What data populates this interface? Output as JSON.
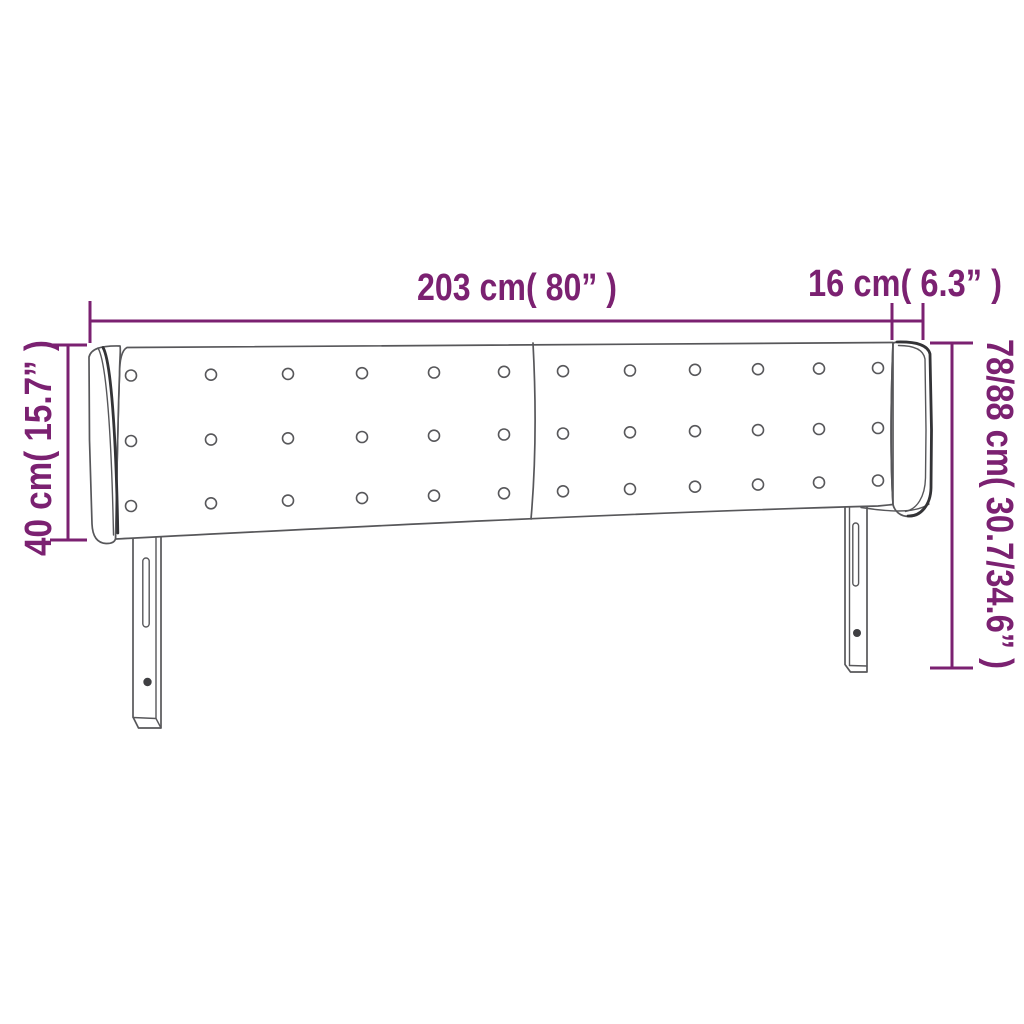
{
  "diagram": {
    "subject": "upholstered-headboard-front-view",
    "drawing": {
      "panels": 2,
      "tufting_button_rows": 3,
      "tufting_button_columns": 12,
      "legs": 2,
      "side_wings": 2
    },
    "labels": {
      "width": "203 cm( 80” )",
      "side_width": "16 cm( 6.3” )",
      "side_height": "40 cm( 15.7” )",
      "total_height": "78/88 cm( 30.7/34.6” )"
    },
    "colors": {
      "dimension_accent": "#7b2171",
      "outline_gray": "#57575a"
    }
  }
}
